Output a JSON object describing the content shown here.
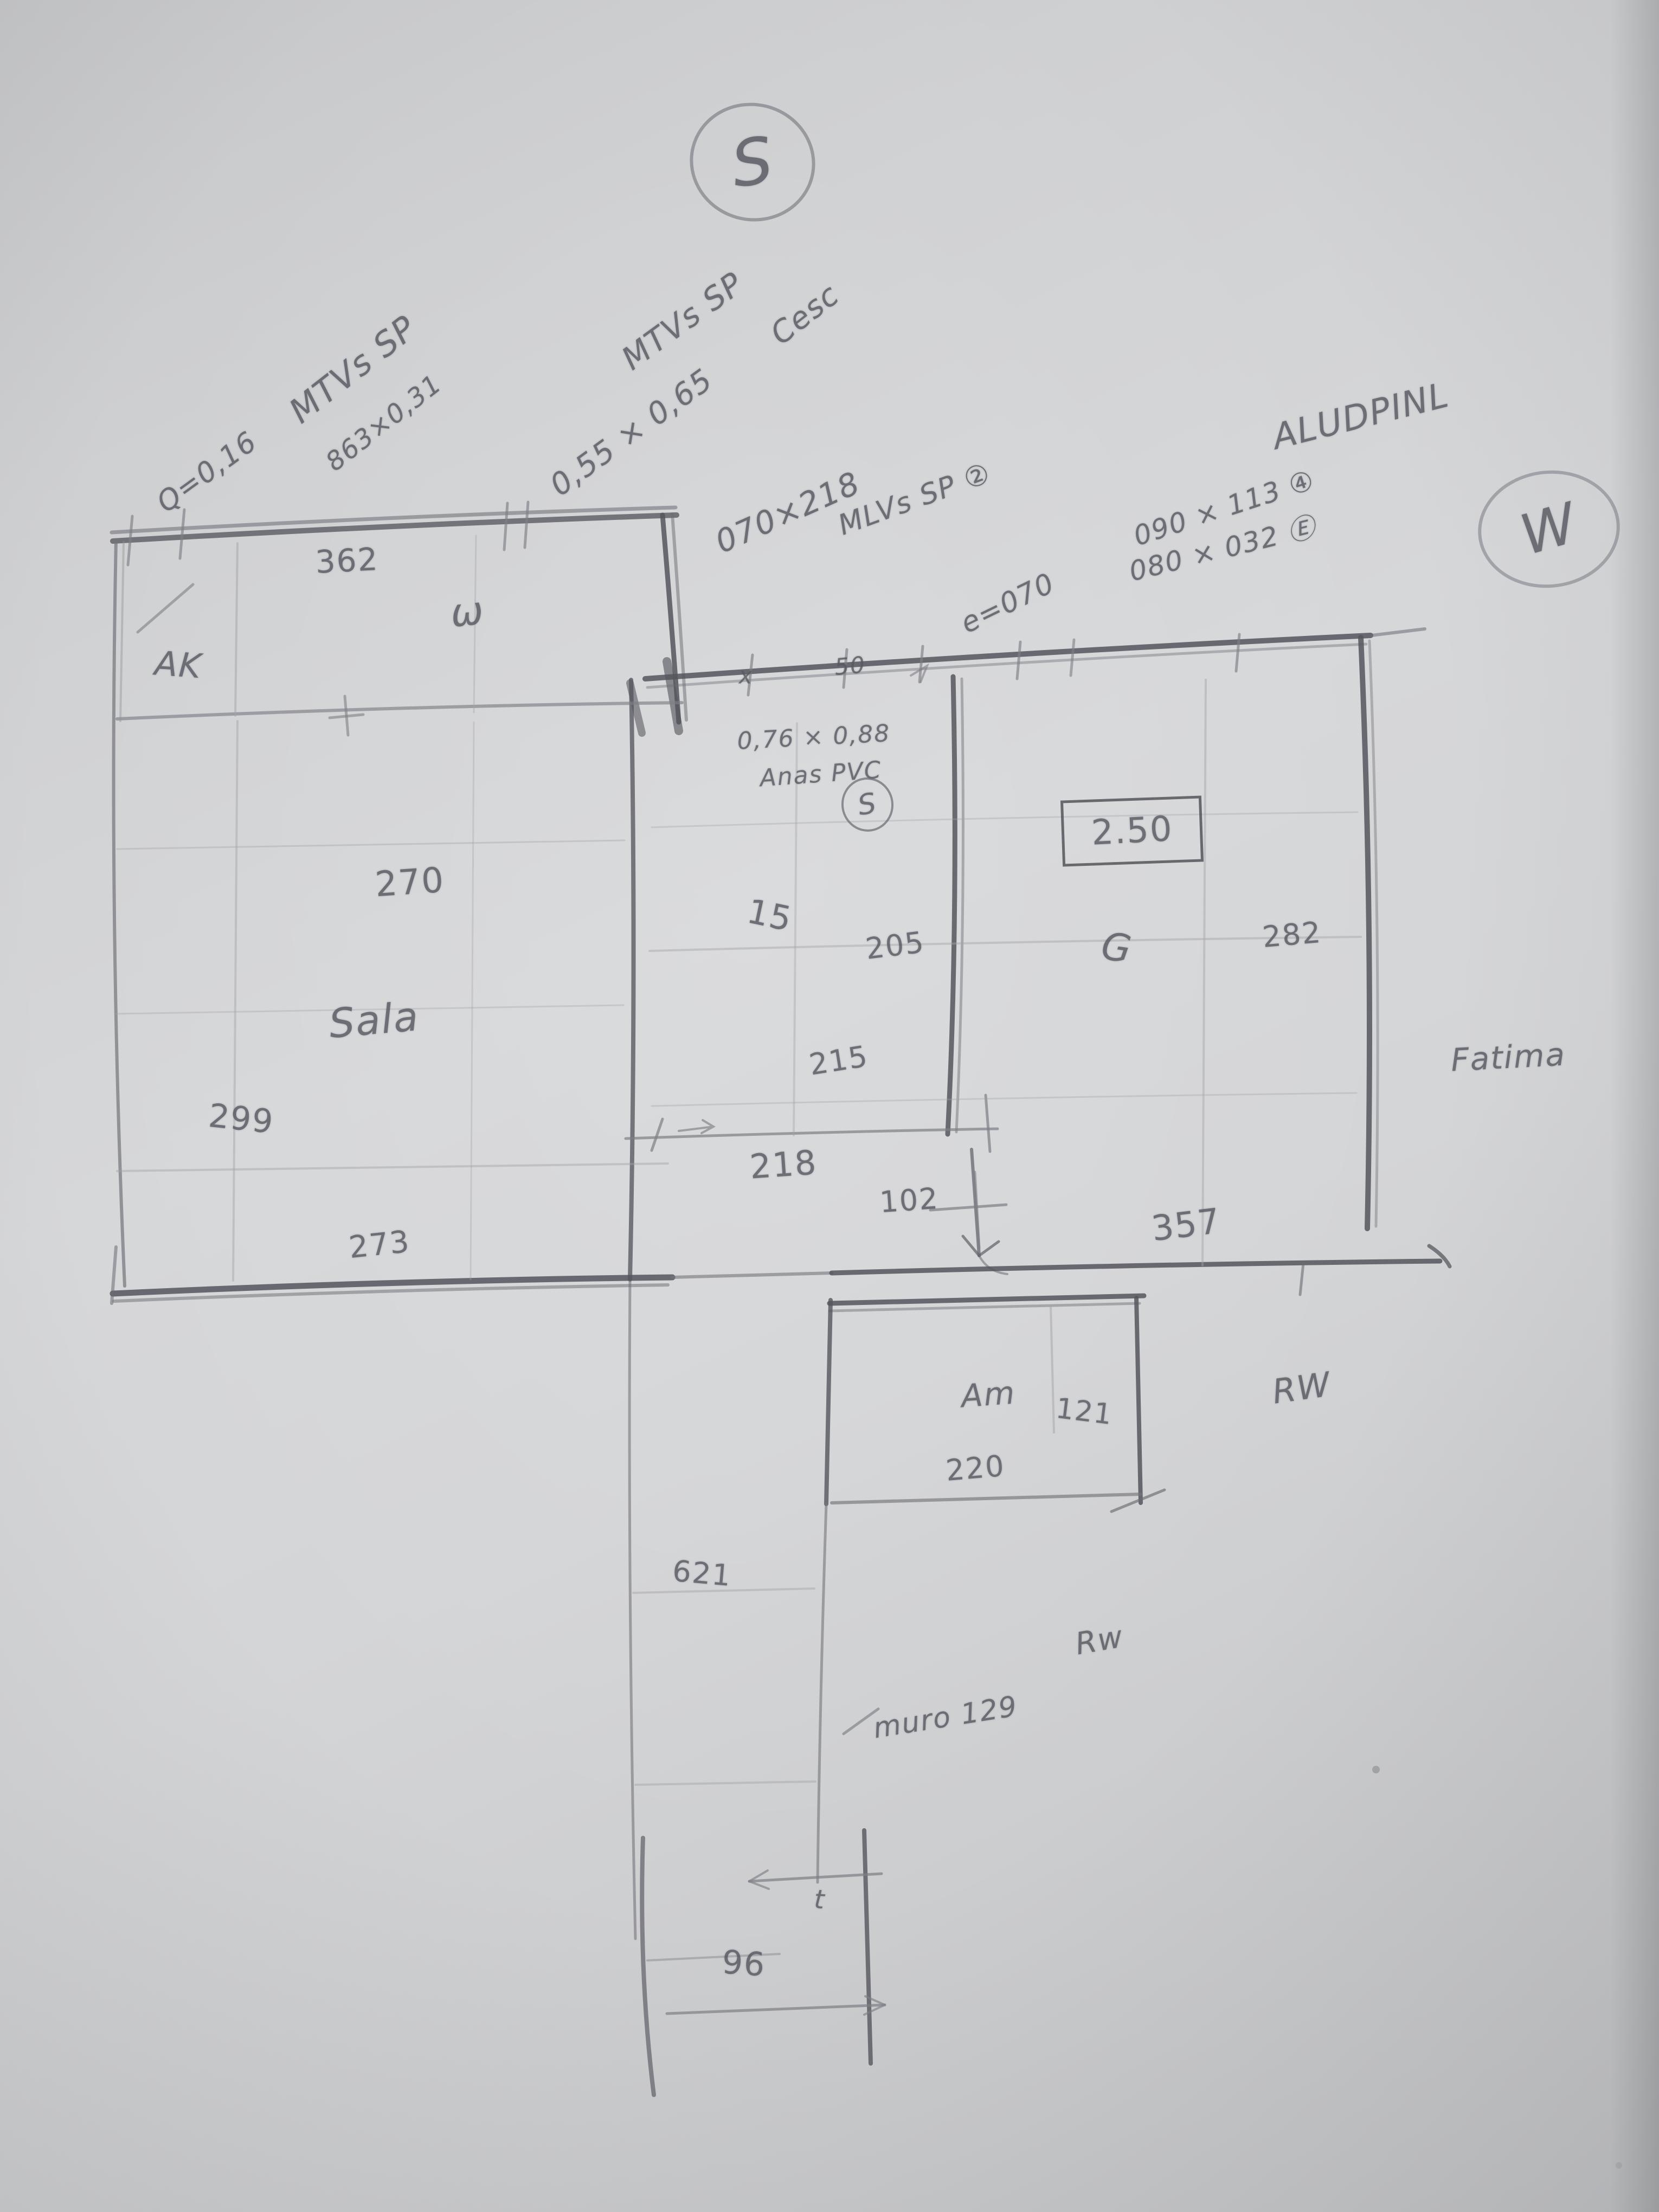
{
  "compass": {
    "south": "S",
    "west": "W"
  },
  "door_notes": {
    "g1": {
      "line1": "MTVs SP",
      "line2": "Q=0,16",
      "line3": "863×0,31"
    },
    "g2": {
      "line1": "MTVs SP",
      "line2": "Cesc",
      "line3": "0,55 × 0,65"
    },
    "g3": {
      "line1": "070×218",
      "line2": "MLVs SP ②"
    },
    "g4": {
      "line1": "e=070"
    },
    "g5": {
      "line1": "ALUDPINL",
      "line2": "090 × 113 ④",
      "line3": "080 × 032 Ⓔ"
    },
    "g6": {
      "line1": "0,76 × 0,88",
      "line2": "Anas PVC",
      "mark": "S"
    }
  },
  "rooms": {
    "sala": "Sala",
    "am": "Am"
  },
  "labels": {
    "ak": "AK",
    "window": "ω",
    "fatima": "Fatima",
    "rw1": "RW",
    "rw2": "Rw",
    "muro": "muro 129",
    "door_g": "G",
    "t": "t",
    "x": "x",
    "n50": "50"
  },
  "dims": {
    "d362": "362",
    "d270": "270",
    "d299": "299",
    "d273": "273",
    "d15": "15",
    "d205": "205",
    "d215": "215",
    "d218": "218",
    "d102": "102",
    "d282": "282",
    "d357": "357",
    "d121": "121",
    "d220": "220",
    "d621": "621",
    "d96": "96",
    "height_box": "2.50"
  }
}
